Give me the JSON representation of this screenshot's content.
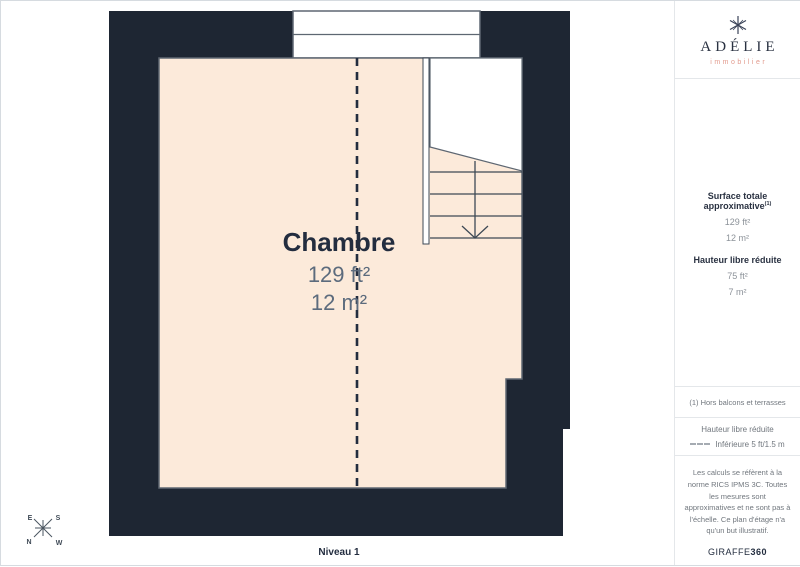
{
  "page": {
    "level_label": "Niveau 1"
  },
  "floor_plan": {
    "room": {
      "name": "Chambre",
      "area_ft": "129 ft²",
      "area_m": "12 m²"
    },
    "compass": {
      "top_left": "E",
      "top_right": "S",
      "bottom_left": "N",
      "bottom_right": "W"
    }
  },
  "sidebar": {
    "logo": {
      "name": "ADÉLIE",
      "subtitle": "immobilier"
    },
    "surface": {
      "title": "Surface totale approximative",
      "title_superscript": "(1)",
      "values": [
        "129 ft²",
        "12 m²"
      ],
      "height_title": "Hauteur libre réduite",
      "height_values": [
        "75 ft²",
        "7 m²"
      ]
    },
    "note": "(1) Hors balcons et terrasses",
    "legend": {
      "title": "Hauteur libre réduite",
      "item": "Inférieure 5 ft/1.5 m"
    },
    "disclaimer": "Les calculs se réfèrent à la norme RICS IPMS 3C. Toutes les mesures sont approximatives et ne sont pas à l'échelle. Ce plan d'étage n'a qu'un but illustratif.",
    "brand": {
      "name": "GIRAFFE",
      "suffix": "360"
    }
  },
  "colors": {
    "wall": "#1E2633",
    "floor": "#FCEADA",
    "outline": "#5E6772",
    "label_navy": "#232D3F",
    "label_gray_blue": "#5C6B7D",
    "accent_salmon": "#E29B8E"
  }
}
